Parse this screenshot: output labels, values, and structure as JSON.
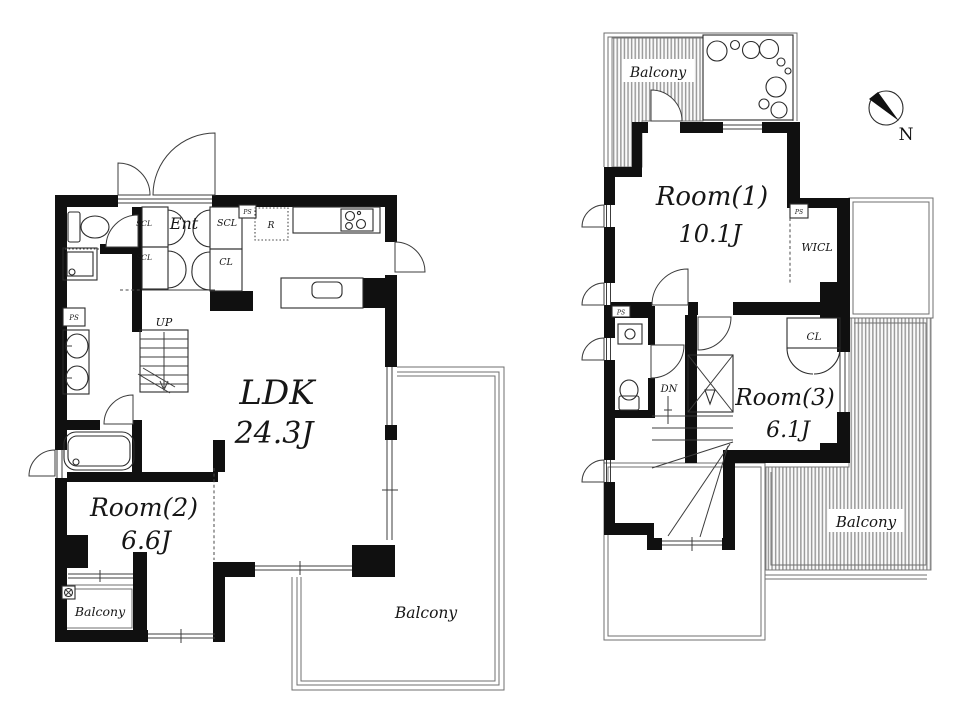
{
  "doc": {
    "type": "floor-plan",
    "floors": 2
  },
  "colors": {
    "wall": "#101010",
    "line": "#3c3c3c",
    "hatch": "#9c9c9c",
    "text": "#161616",
    "bg": "#ffffff"
  },
  "f1": {
    "ldk_name": "LDK",
    "ldk_size": "24.3J",
    "room2_name": "Room(2)",
    "room2_size": "6.6J",
    "ent": "Ent",
    "scl_a": "SCL",
    "scl_b": "SCL",
    "scl_c": "SCL",
    "cl": "CL",
    "ps_top": "PS",
    "ps_left": "PS",
    "fridge": "R",
    "stairs": "UP",
    "balcony_small": "Balcony",
    "balcony_main": "Balcony"
  },
  "f2": {
    "room1_name": "Room(1)",
    "room1_size": "10.1J",
    "room3_name": "Room(3)",
    "room3_size": "6.1J",
    "wicl": "WICL",
    "cl": "CL",
    "ps_top": "PS",
    "ps_left": "PS",
    "stairs": "DN",
    "balcony_top": "Balcony",
    "balcony_right": "Balcony"
  },
  "compass": {
    "north": "N"
  }
}
